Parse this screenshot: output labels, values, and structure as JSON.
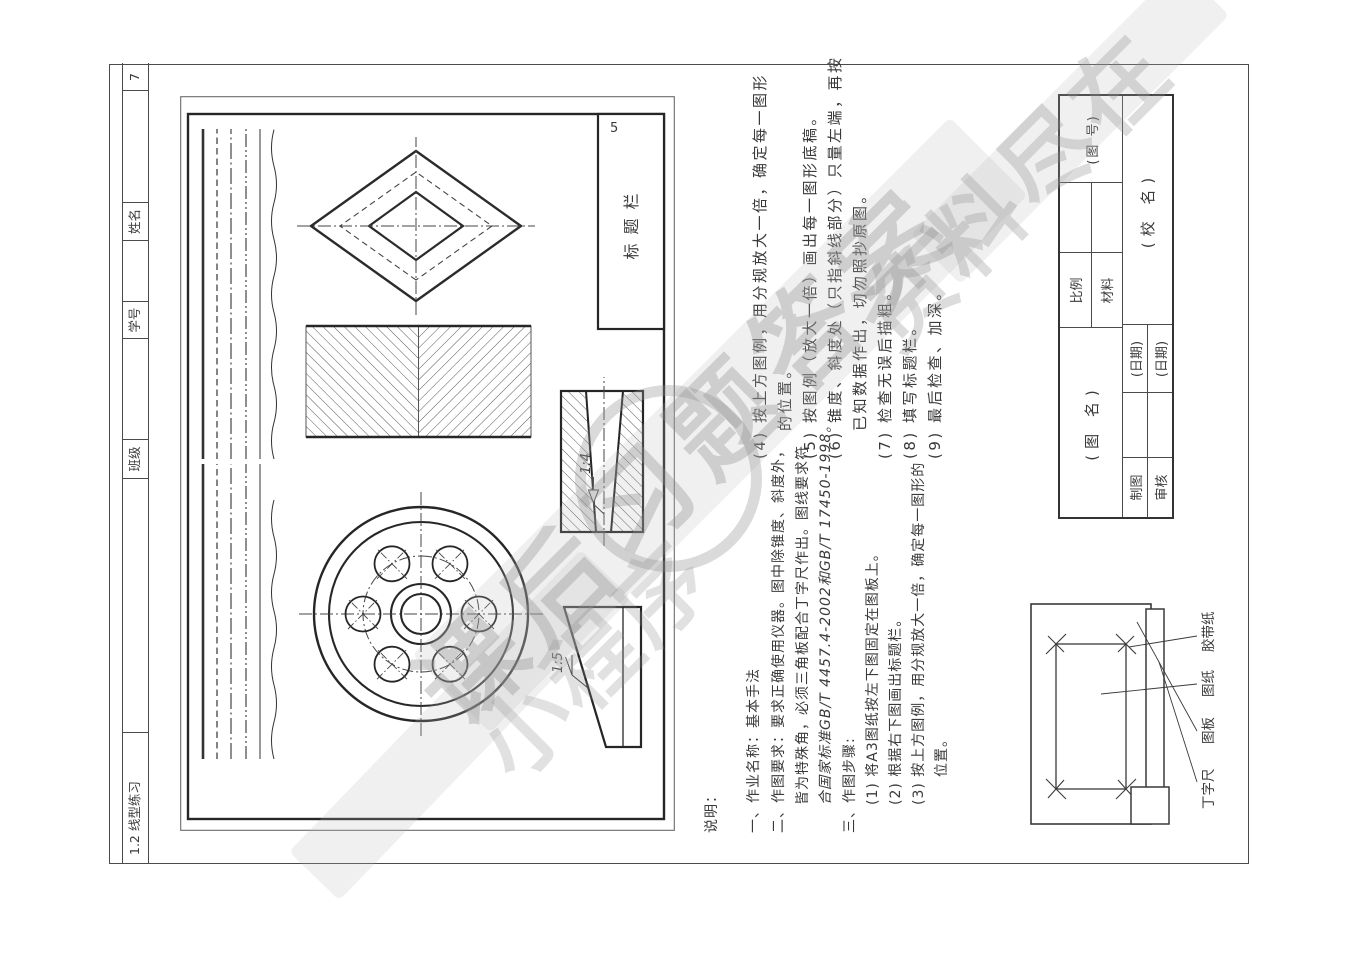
{
  "header_strip": {
    "exercise_title": "1.2 线型练习",
    "class_label": "班级",
    "student_id_label": "学号",
    "name_label": "姓名",
    "page_number": "7"
  },
  "example": {
    "title_block_label": "标题栏",
    "title_block_dim": "5",
    "taper_label": "1:4",
    "slope_label": "1:5"
  },
  "notes": {
    "left": [
      "说明：",
      "一、作业名称：基本手法",
      "二、作图要求：要求正确使用仪器。图中除锥度、斜度外，",
      "皆为特殊角，必须三角板配合丁字尺作出。图线要求符",
      "合国家标准GB/T 4457.4-2002和GB/T 17450-1998。",
      "三、作图步骤:",
      "(1) 将A3图纸按左下图固定在图板上。",
      "(2) 根据右下图画出标题栏。",
      "(3) 按上方图例，用分规放大一倍，确定每一图形的",
      "位置。"
    ],
    "right": [
      "(4) 按上方图例，用分规放大一倍，确定每一图形",
      "的位置。",
      "(5) 按图例（放大一倍）画出每一图形底稿。",
      "(6) 锥度、斜度处（只指斜线部分）只量左端，再按",
      "已知数据作出，切勿照抄原图。",
      "(7) 检查无误后描粗。",
      "(8) 填写标题栏。",
      "(9) 最后检查、加深。"
    ]
  },
  "title_block": {
    "drawing_name": "(图  名)",
    "scale_label": "比例",
    "material_label": "材料",
    "drawing_no": "(图  号)",
    "drafter_label": "制图",
    "checker_label": "审核",
    "date1": "(日期)",
    "date2": "(日期)",
    "school_name": "(校  名)"
  },
  "board_figure": {
    "tsquare_label": "丁字尺",
    "board_label": "图板",
    "paper_label": "图纸",
    "tape_label": "胶带纸"
  },
  "watermark": {
    "text_main": "课后习题答案",
    "text_corner": "资料尽在",
    "text_mini": "小程序"
  }
}
